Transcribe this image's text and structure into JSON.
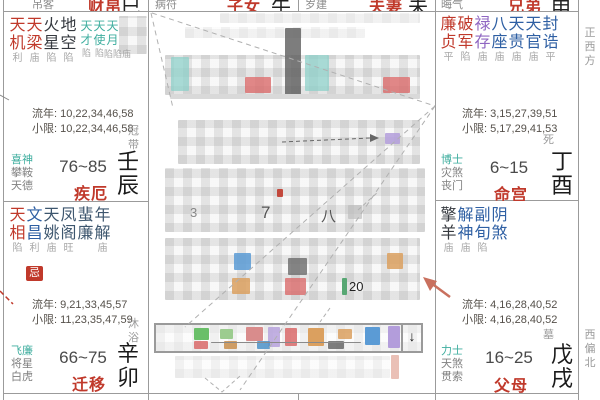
{
  "colors": {
    "main-star": "#c0392b",
    "blue-star": "#2e5fa3",
    "slate-star": "#3d566e",
    "purple-star": "#8f66c2",
    "teal-star": "#3fae9f",
    "dark-star": "#35393f",
    "bright-gray": "#a8a8a8",
    "label-gray": "#808080",
    "flow-text": "#55504a",
    "age-text": "#4a4a4a",
    "palace-red": "#c0392b",
    "branch-black": "#1a1a1a",
    "border": "#9b9b9b",
    "badge-bg": "#c0392b",
    "badge-fg": "#ffffff"
  },
  "top_fragments": [
    {
      "shensha": "吊客",
      "palace": "财帛",
      "branch": "巳"
    },
    {
      "shensha": "病符",
      "palace": "子女",
      "branch": "午"
    },
    {
      "shensha": "岁建",
      "palace": "夫妻",
      "branch": "未"
    },
    {
      "shensha": "晦气",
      "palace": "兄弟",
      "branch": "申"
    }
  ],
  "palaces": {
    "chen": {
      "stars": [
        {
          "name": "天机",
          "bright": "利"
        },
        {
          "name": "天梁",
          "bright": "庙"
        },
        {
          "name": "火星",
          "bright": "陷"
        },
        {
          "name": "地空",
          "bright": "陷"
        }
      ],
      "minor_stars": [
        {
          "name": "天才",
          "bright": "陷"
        },
        {
          "name": "天使",
          "bright": "陷"
        },
        {
          "name": "天月",
          "bright": ""
        }
      ],
      "minor_bright_extra": "陷陷庙",
      "liunian": "流年: 10,22,34,46,58",
      "xiaoxian": "小限: 10,22,34,46,58",
      "stage": "冠带",
      "shensha": [
        "喜神",
        "攀鞍",
        "天德"
      ],
      "age_range": "76~85",
      "palace_name": "疾厄",
      "ganzhi": "壬辰"
    },
    "mao": {
      "stars": [
        {
          "name": "天相",
          "bright": "陷"
        },
        {
          "name": "文昌",
          "bright": "利"
        },
        {
          "name": "天姚",
          "bright": "庙"
        },
        {
          "name": "凤阁",
          "bright": "旺"
        },
        {
          "name": "蜚廉",
          "bright": ""
        },
        {
          "name": "年解",
          "bright": "庙"
        }
      ],
      "hua_badge": "忌",
      "liunian": "流年: 9,21,33,45,57",
      "xiaoxian": "小限: 11,23,35,47,59",
      "stage": "沐浴",
      "shensha": [
        "飞廉",
        "将星",
        "白虎"
      ],
      "age_range": "66~75",
      "palace_name": "迁移",
      "ganzhi": "辛卯"
    },
    "you": {
      "stars": [
        {
          "name": "廉贞",
          "bright": "平"
        },
        {
          "name": "破军",
          "bright": "陷"
        },
        {
          "name": "禄存",
          "bright": "庙"
        },
        {
          "name": "八座",
          "bright": "庙"
        },
        {
          "name": "天贵",
          "bright": "庙"
        },
        {
          "name": "天官",
          "bright": "庙"
        },
        {
          "name": "封诰",
          "bright": "平"
        }
      ],
      "liunian": "流年: 3,15,27,39,51",
      "xiaoxian": "小限: 5,17,29,41,53",
      "stage": "死",
      "shensha": [
        "博士",
        "灾煞",
        "丧门"
      ],
      "age_range": "6~15",
      "palace_name": "命宫",
      "ganzhi": "丁酉"
    },
    "xu": {
      "stars": [
        {
          "name": "擎羊",
          "bright": "庙"
        },
        {
          "name": "解神",
          "bright": "庙"
        },
        {
          "name": "副旬",
          "bright": "陷"
        },
        {
          "name": "阴煞",
          "bright": ""
        }
      ],
      "liunian": "流年: 4,16,28,40,52",
      "xiaoxian": "小限: 4,16,28,40,52",
      "stage": "墓",
      "shensha": [
        "力士",
        "天煞",
        "贯索"
      ],
      "age_range": "16~25",
      "palace_name": "父母",
      "ganzhi": "戊戌"
    }
  },
  "directions": {
    "west": "正西方",
    "west_north": "西偏北"
  },
  "center": {
    "redacted": true,
    "visible_marks": {
      "num_a": "7",
      "num_b": "八",
      "num_c": "3",
      "age_marker": "20",
      "down_arrow": "↓"
    }
  }
}
